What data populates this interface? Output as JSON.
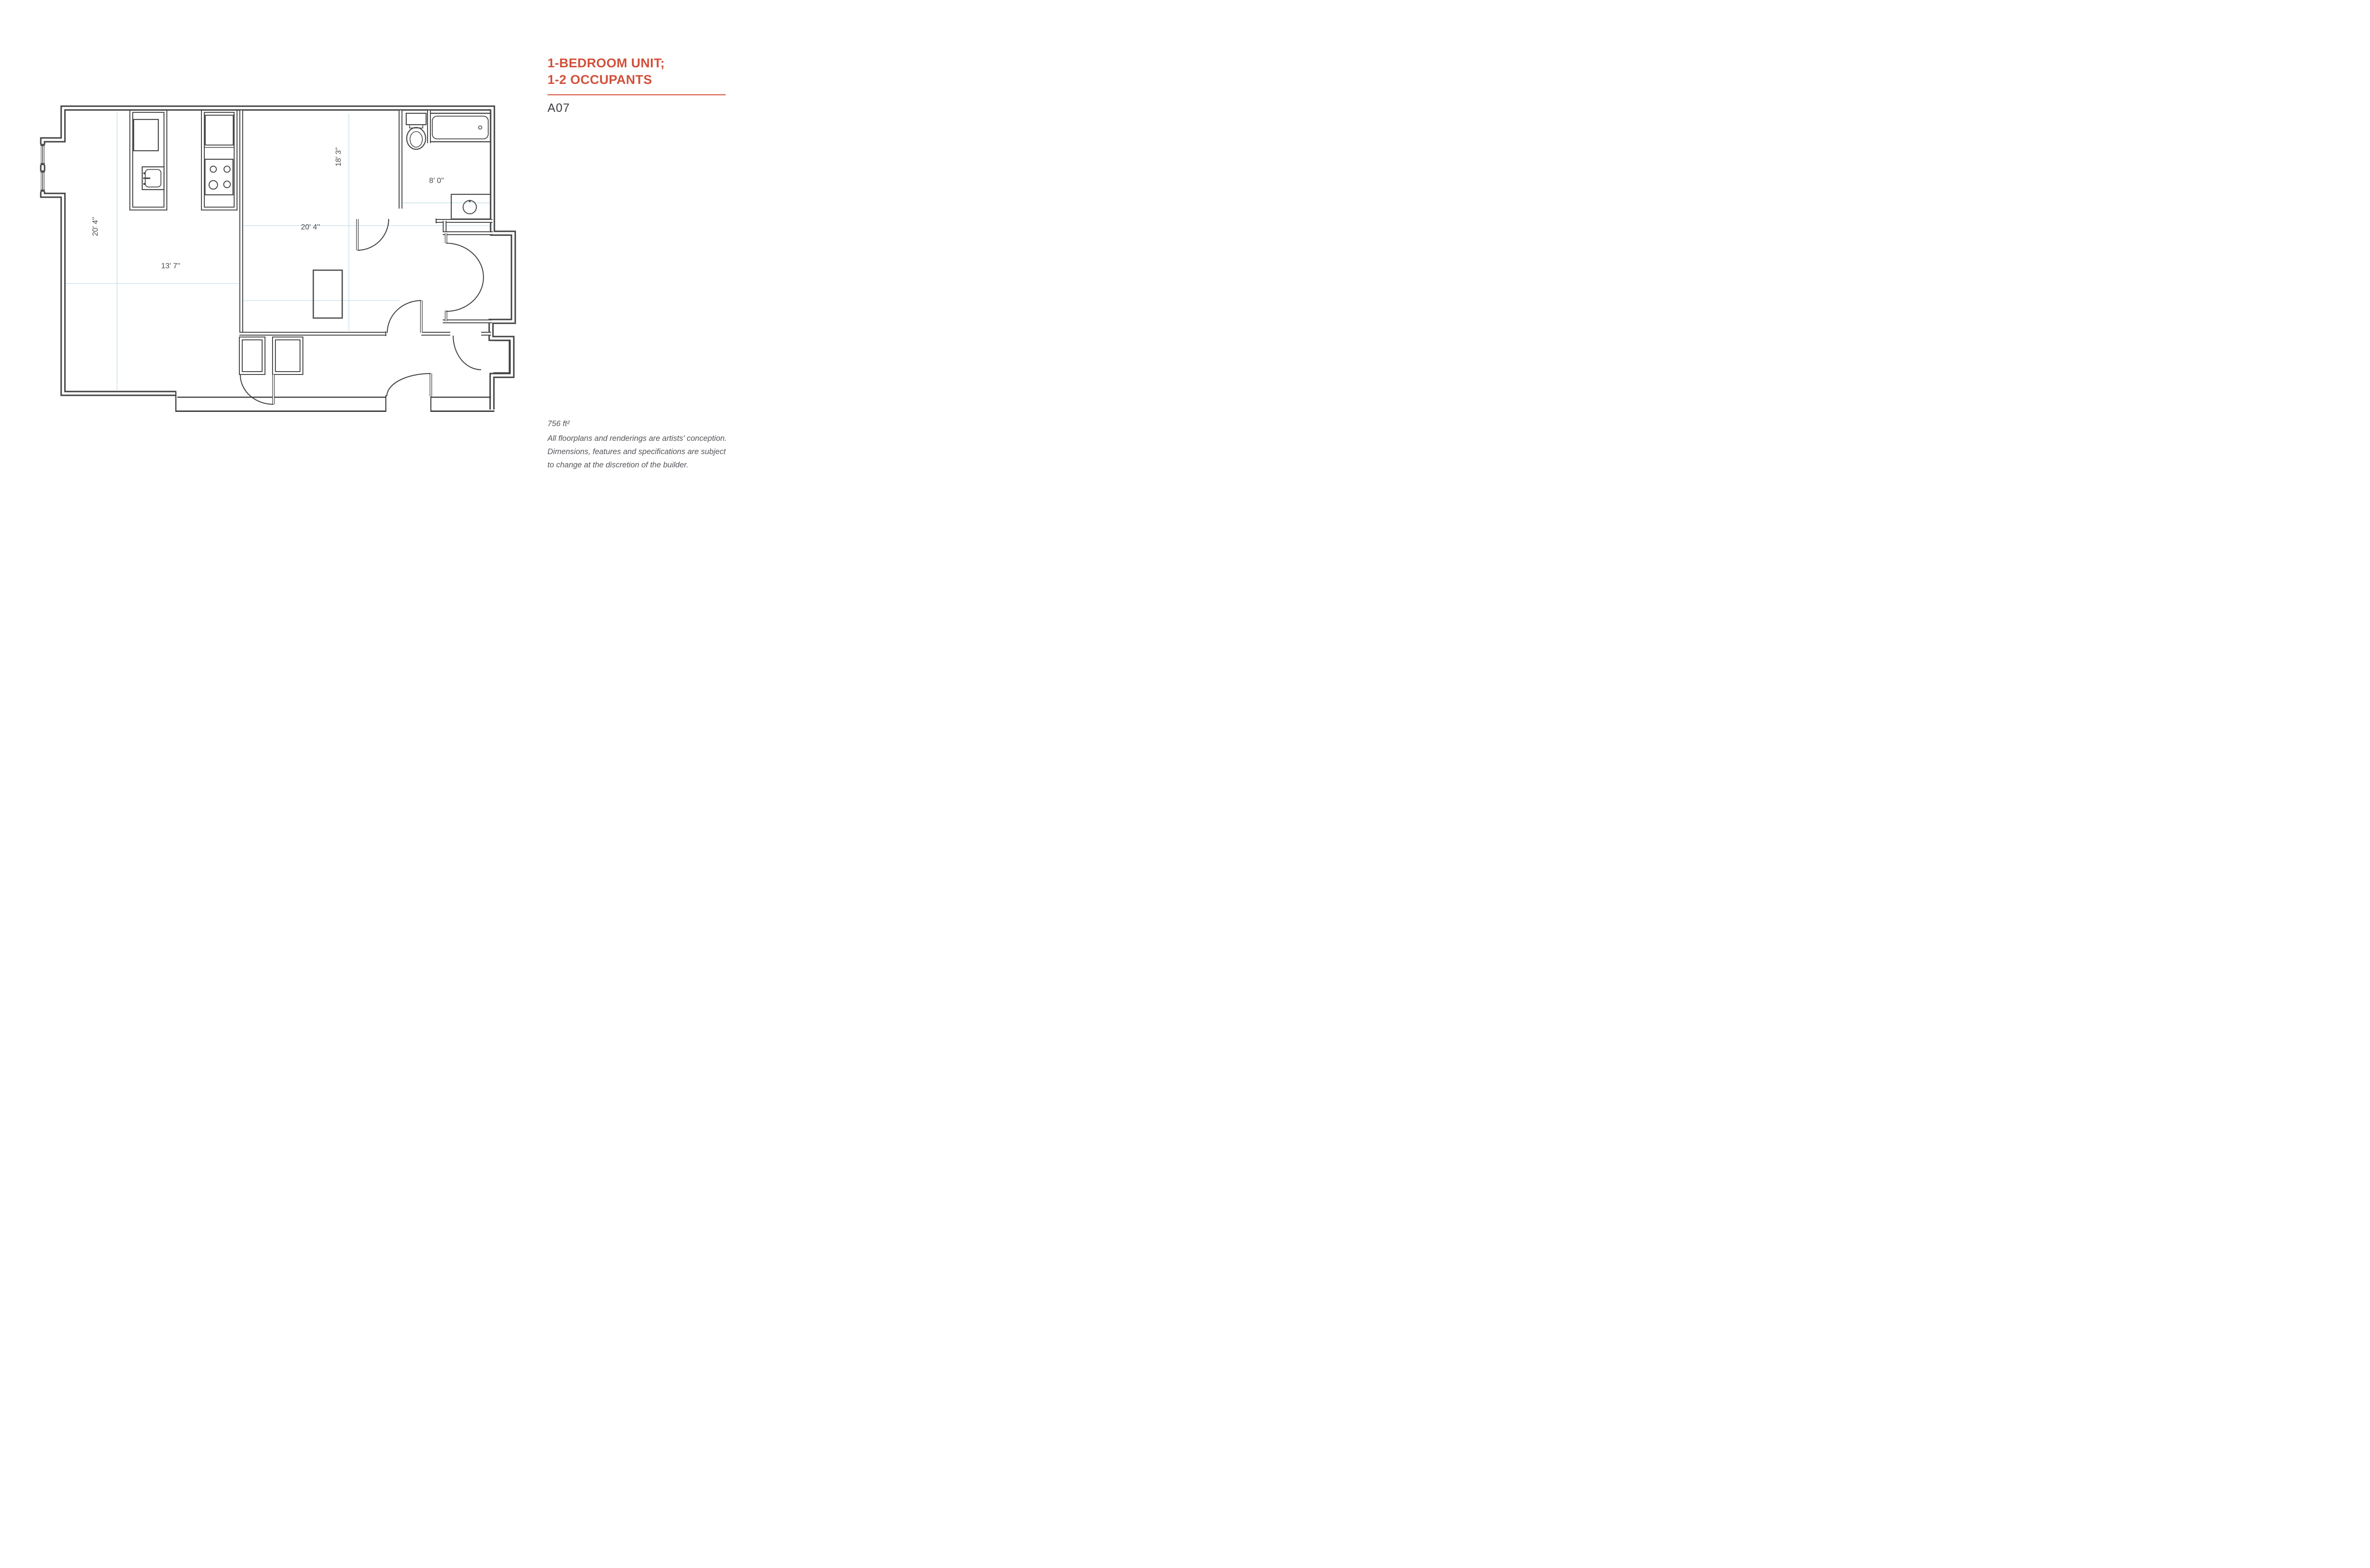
{
  "header": {
    "title_line1": "1-BEDROOM UNIT;",
    "title_line2": "1-2 OCCUPANTS",
    "unit_code": "A07"
  },
  "floorplan": {
    "dimensions": {
      "living_vertical": "20' 4''",
      "living_horizontal": "13' 7''",
      "bedroom_vertical": "18' 3''",
      "bedroom_horizontal": "20' 4''",
      "bathroom_horizontal": "8' 0''"
    },
    "fixtures": [
      "bay-windows",
      "kitchen-island-sink",
      "kitchen-stove",
      "bathtub",
      "toilet",
      "bathroom-vanity-sink",
      "bedroom-closets",
      "wardrobe-double-doors",
      "entry-door"
    ]
  },
  "footer": {
    "area": "756 ft²",
    "disclaimer_line1": "All floorplans and renderings are artists' conception.",
    "disclaimer_line2": "Dimensions, features and specifications are subject",
    "disclaimer_line3": "to change at the discretion of the builder."
  },
  "colors": {
    "accent": "#d2503a",
    "wall": "#414141",
    "gridline": "#c2dde6",
    "label": "#4a4a4a",
    "text": "#54555a"
  }
}
